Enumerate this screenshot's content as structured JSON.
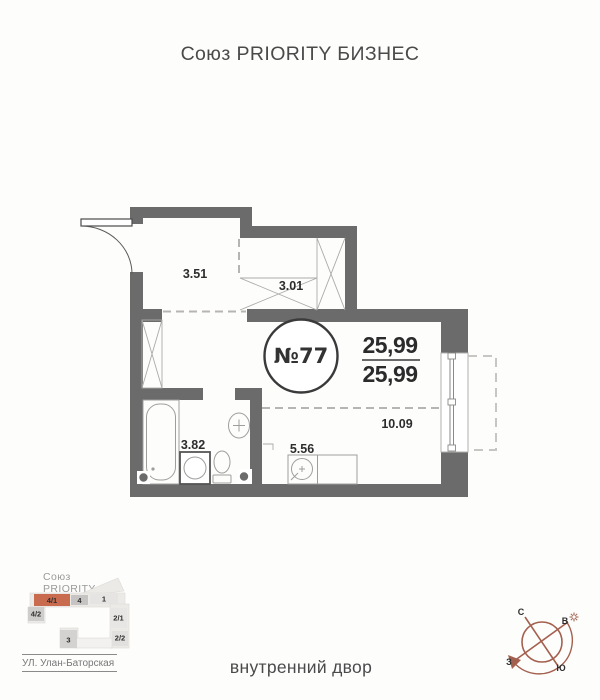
{
  "header": {
    "title": "Союз PRIORITY БИЗНЕС"
  },
  "plan": {
    "apartment_number": "№77",
    "area_top": "25,99",
    "area_bottom": "25,99",
    "wall_color": "#6b6b6b",
    "rooms": [
      {
        "name": "hallway",
        "area": "3.51"
      },
      {
        "name": "wardrobe",
        "area": "3.01"
      },
      {
        "name": "bathroom",
        "area": "3.82"
      },
      {
        "name": "kitchen",
        "area": "5.56"
      },
      {
        "name": "living-room",
        "area": "10.09"
      }
    ]
  },
  "site_plan": {
    "complex_name_line1": "Союз",
    "complex_name_line2": "PRIORITY",
    "street": "УЛ. Улан-Баторская",
    "buildings": [
      "4/1",
      "4",
      "1",
      "4/2",
      "2/1",
      "2/2",
      "3"
    ],
    "highlighted_building": "4/1",
    "highlight_color": "#c96b4e"
  },
  "compass": {
    "north": "С",
    "east": "В",
    "south": "Ю",
    "west": "З",
    "color": "#a4604e"
  },
  "footer": {
    "label": "внутренний двор"
  }
}
